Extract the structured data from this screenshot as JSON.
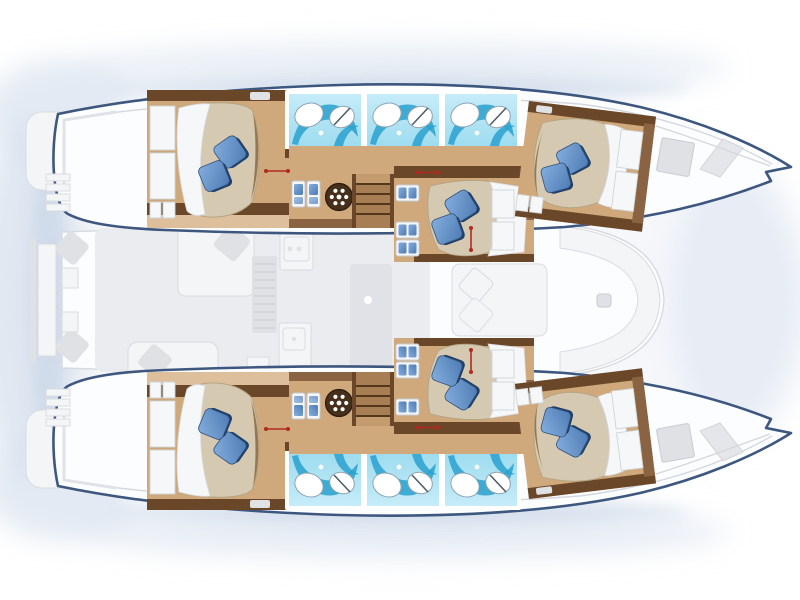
{
  "diagram": {
    "type": "catamaran-floor-plan",
    "view": "top-down",
    "bow_direction": "right",
    "description": "Top-view accommodation plan of a sailing catamaran: six double cabins with blue pillows, six blue en-suite bathrooms, central saloon with galley and dining table, two companionway stairs, forward cockpit and aft platform.",
    "counts": {
      "hulls": 2,
      "double_cabins": 6,
      "bathrooms": 6,
      "companionway_stairs": 2,
      "round_hatches": 2,
      "blue_pillows": 12
    }
  },
  "areas": [
    {
      "id": "cabin-aft-top",
      "label": "Aft double cabin - top hull"
    },
    {
      "id": "cabin-mid-top",
      "label": "Mid double cabin - top"
    },
    {
      "id": "cabin-fwd-top",
      "label": "Forward double cabin - top hull"
    },
    {
      "id": "cabin-aft-bottom",
      "label": "Aft double cabin - bottom hull"
    },
    {
      "id": "cabin-mid-bottom",
      "label": "Mid double cabin - bottom"
    },
    {
      "id": "cabin-fwd-bottom",
      "label": "Forward double cabin - bottom hull"
    },
    {
      "id": "bathrooms-top",
      "label": "Three en-suite bathrooms - top hull"
    },
    {
      "id": "bathrooms-bottom",
      "label": "Three en-suite bathrooms - bottom hull"
    },
    {
      "id": "saloon",
      "label": "Saloon with galley, sofa and dining table"
    },
    {
      "id": "cockpit-fwd",
      "label": "Forward cockpit seating"
    },
    {
      "id": "stern-platform",
      "label": "Aft platform and transom steps"
    },
    {
      "id": "bow-deck",
      "label": "Bow deck with hatches"
    }
  ],
  "colors": {
    "outline": "#3d577f",
    "deck": "#fcfdfe",
    "deck_seam": "#d3d8df",
    "halo": "#d7e1ee",
    "shadow": "#bfcfe2",
    "wood_trim": "#6b4729",
    "wood_mid": "#8a6442",
    "wood_dark": "#53371d",
    "wood_step": "#a87f55",
    "wood_step_light": "#c49b6d",
    "floor": "#cfa87c",
    "floor_light": "#debf9b",
    "bed_cover": "#d5c9b2",
    "bed_edge": "#b3a584",
    "bed_foot": "#96764f",
    "sheet": "#f6f7f8",
    "sheet_line": "#d9dce0",
    "pillow_light": "#85aedd",
    "pillow_mid": "#4d7bb4",
    "pillow_dark": "#1f3f66",
    "bath_light": "#c6ecf8",
    "bath": "#9edcf0",
    "bath_swoosh": "#2ea3cf",
    "fixture": "#ffffff",
    "fixture_line": "#8fa3b0",
    "faded": "#e9ebee",
    "faded_line": "#d7dadf",
    "faded_white": "#f4f5f7",
    "faded_dark": "#dfe1e5",
    "red": "#b02a20",
    "box_frame": "#c6ccd3"
  }
}
